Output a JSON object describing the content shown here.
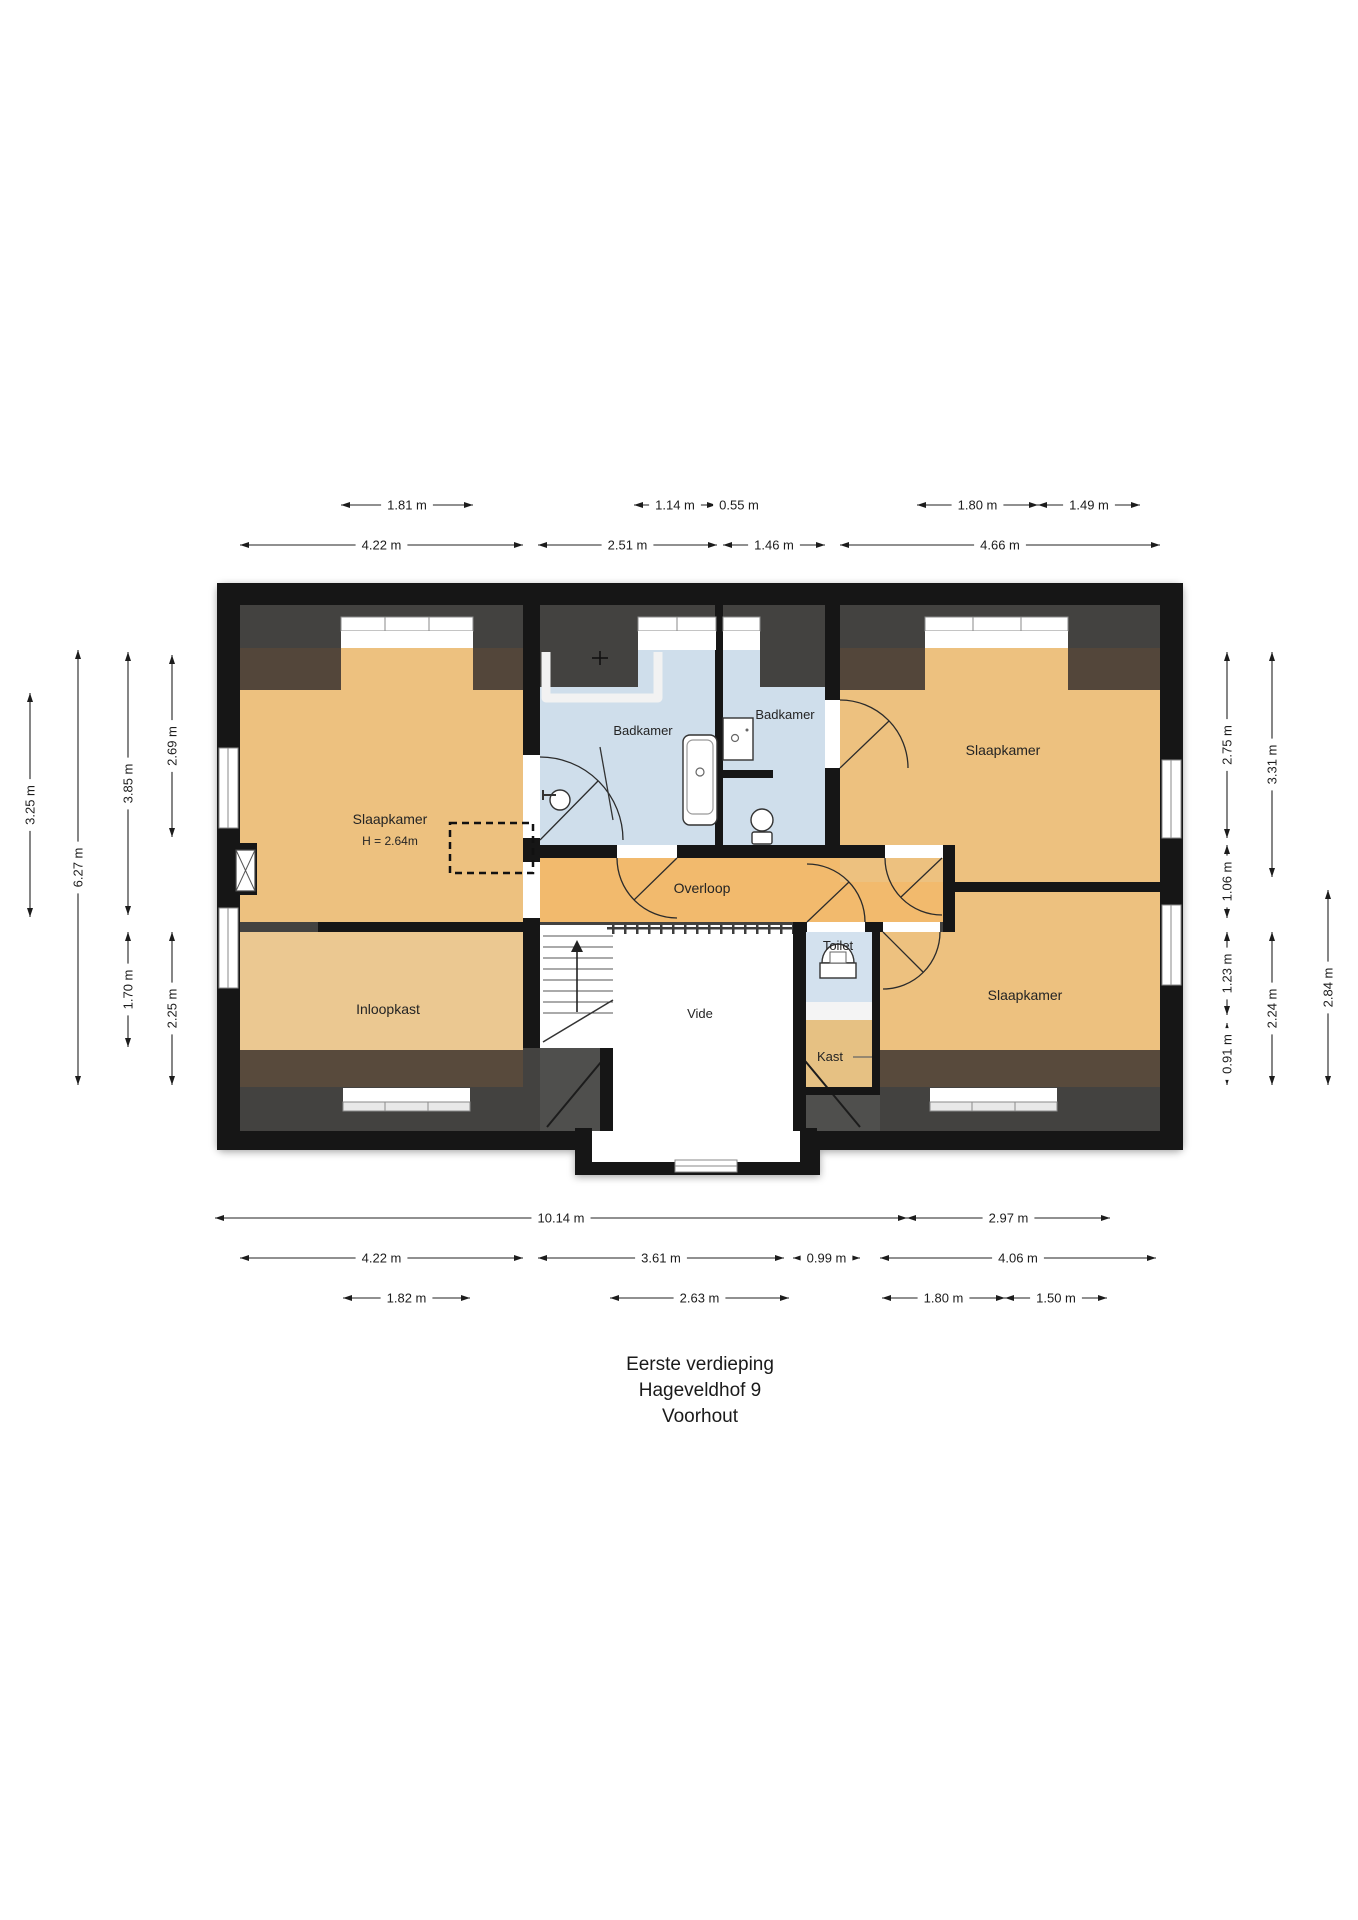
{
  "title": {
    "line1": "Eerste verdieping",
    "line2": "Hageveldhof 9",
    "line3": "Voorhout"
  },
  "rooms": [
    {
      "name": "slaapkamer-left",
      "label": "Slaapkamer",
      "x": 390,
      "y": 824,
      "size": 14
    },
    {
      "name": "slaapkamer-left-height",
      "label": "H = 2.64m",
      "x": 390,
      "y": 845,
      "size": 12
    },
    {
      "name": "badkamer-1",
      "label": "Badkamer",
      "x": 643,
      "y": 735,
      "size": 13
    },
    {
      "name": "badkamer-2",
      "label": "Badkamer",
      "x": 785,
      "y": 719,
      "size": 13
    },
    {
      "name": "slaapkamer-top-right",
      "label": "Slaapkamer",
      "x": 1003,
      "y": 755,
      "size": 14
    },
    {
      "name": "overloop",
      "label": "Overloop",
      "x": 702,
      "y": 893,
      "size": 14
    },
    {
      "name": "inloopkast",
      "label": "Inloopkast",
      "x": 388,
      "y": 1014,
      "size": 14
    },
    {
      "name": "vide",
      "label": "Vide",
      "x": 700,
      "y": 1018,
      "size": 13
    },
    {
      "name": "toilet",
      "label": "Toilet",
      "x": 838,
      "y": 950,
      "size": 13
    },
    {
      "name": "kast",
      "label": "Kast",
      "x": 830,
      "y": 1061,
      "size": 13
    },
    {
      "name": "slaapkamer-bottom-right",
      "label": "Slaapkamer",
      "x": 1025,
      "y": 1000,
      "size": 14
    }
  ],
  "dimensions": {
    "horizontal": [
      {
        "label": "1.81 m",
        "x1": 341,
        "x2": 473,
        "y": 505
      },
      {
        "label": "1.14 m",
        "x1": 634,
        "x2": 716,
        "y": 505
      },
      {
        "label": "0.55 m",
        "x1": 716,
        "x2": 754,
        "y": 505,
        "labelX": 739
      },
      {
        "label": "1.80 m",
        "x1": 917,
        "x2": 1038,
        "y": 505
      },
      {
        "label": "1.49 m",
        "x1": 1038,
        "x2": 1140,
        "y": 505
      },
      {
        "label": "4.22 m",
        "x1": 240,
        "x2": 523,
        "y": 545
      },
      {
        "label": "2.51 m",
        "x1": 538,
        "x2": 717,
        "y": 545
      },
      {
        "label": "1.46 m",
        "x1": 723,
        "x2": 825,
        "y": 545
      },
      {
        "label": "4.66 m",
        "x1": 840,
        "x2": 1160,
        "y": 545
      },
      {
        "label": "10.14 m",
        "x1": 215,
        "x2": 907,
        "y": 1218
      },
      {
        "label": "2.97 m",
        "x1": 907,
        "x2": 1110,
        "y": 1218
      },
      {
        "label": "4.22 m",
        "x1": 240,
        "x2": 523,
        "y": 1258
      },
      {
        "label": "3.61 m",
        "x1": 538,
        "x2": 784,
        "y": 1258
      },
      {
        "label": "0.99 m",
        "x1": 793,
        "x2": 860,
        "y": 1258
      },
      {
        "label": "4.06 m",
        "x1": 880,
        "x2": 1156,
        "y": 1258
      },
      {
        "label": "1.82 m",
        "x1": 343,
        "x2": 470,
        "y": 1298
      },
      {
        "label": "2.63 m",
        "x1": 610,
        "x2": 789,
        "y": 1298
      },
      {
        "label": "1.80 m",
        "x1": 882,
        "x2": 1005,
        "y": 1298
      },
      {
        "label": "1.50 m",
        "x1": 1005,
        "x2": 1107,
        "y": 1298
      }
    ],
    "vertical": [
      {
        "label": "3.25 m",
        "x": 30,
        "y1": 693,
        "y2": 917
      },
      {
        "label": "6.27 m",
        "x": 78,
        "y1": 650,
        "y2": 1085
      },
      {
        "label": "3.85 m",
        "x": 128,
        "y1": 652,
        "y2": 915
      },
      {
        "label": "1.70 m",
        "x": 128,
        "y1": 932,
        "y2": 1047
      },
      {
        "label": "2.69 m",
        "x": 172,
        "y1": 655,
        "y2": 837
      },
      {
        "label": "2.25 m",
        "x": 172,
        "y1": 932,
        "y2": 1085
      },
      {
        "label": "2.75 m",
        "x": 1227,
        "y1": 652,
        "y2": 838
      },
      {
        "label": "1.06 m",
        "x": 1227,
        "y1": 845,
        "y2": 918
      },
      {
        "label": "1.23 m",
        "x": 1227,
        "y1": 932,
        "y2": 1015
      },
      {
        "label": "0.91 m",
        "x": 1227,
        "y1": 1023,
        "y2": 1085
      },
      {
        "label": "3.31 m",
        "x": 1272,
        "y1": 652,
        "y2": 877
      },
      {
        "label": "2.24 m",
        "x": 1272,
        "y1": 932,
        "y2": 1085
      },
      {
        "label": "2.84 m",
        "x": 1328,
        "y1": 890,
        "y2": 1085
      }
    ]
  },
  "colors": {
    "wall": "#161616",
    "eaves_gray": "#434240",
    "eaves_brown": "#53463a",
    "room_tan": "#edc17f",
    "overloop_orange": "#f2ba6d",
    "inloopkast_tan": "#ebc891",
    "bathroom_blue": "#cfdeeb",
    "void_white": "#ffffff"
  }
}
